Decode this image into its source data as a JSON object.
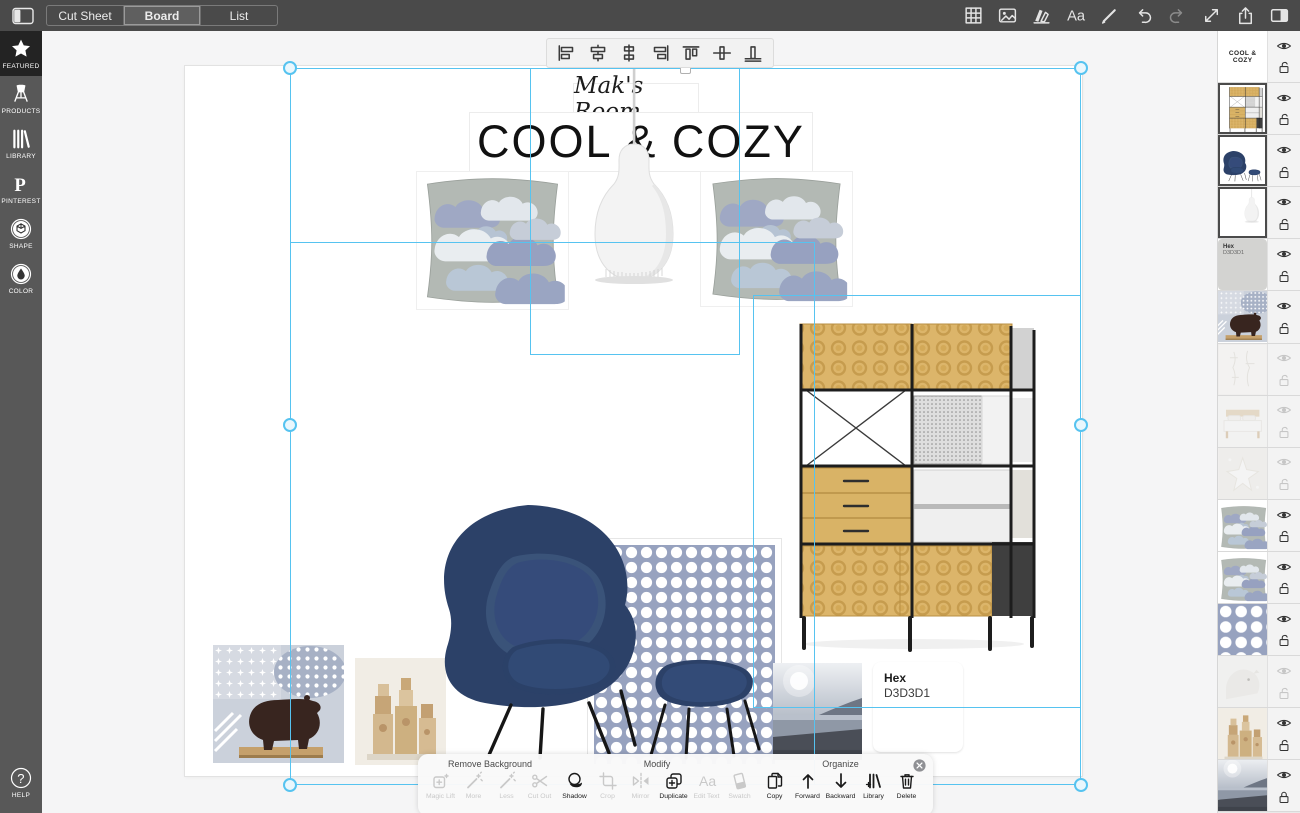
{
  "topbar": {
    "tabs": [
      {
        "label": "Cut Sheet",
        "selected": false
      },
      {
        "label": "Board",
        "selected": true
      },
      {
        "label": "List",
        "selected": false
      }
    ],
    "tools": [
      {
        "icon": "grid",
        "enabled": true
      },
      {
        "icon": "image",
        "enabled": true
      },
      {
        "icon": "boards",
        "enabled": true
      },
      {
        "icon": "text",
        "enabled": true
      },
      {
        "icon": "draw",
        "enabled": true
      },
      {
        "icon": "undo",
        "enabled": true
      },
      {
        "icon": "redo",
        "enabled": false
      },
      {
        "icon": "resize",
        "enabled": true
      },
      {
        "icon": "share",
        "enabled": true
      },
      {
        "icon": "panels",
        "enabled": true
      }
    ]
  },
  "sidebar": {
    "items": [
      {
        "label": "FEATURED",
        "icon": "star",
        "active": true
      },
      {
        "label": "PRODUCTS",
        "icon": "chair",
        "active": false
      },
      {
        "label": "LIBRARY",
        "icon": "books",
        "active": false
      },
      {
        "label": "PINTEREST",
        "icon": "pinterest",
        "active": false
      },
      {
        "label": "SHAPE",
        "icon": "cube",
        "active": false
      },
      {
        "label": "COLOR",
        "icon": "drop",
        "active": false
      }
    ],
    "help": {
      "label": "HELP",
      "icon": "question"
    }
  },
  "align_toolbar": {
    "icons": [
      "align-left",
      "align-center-h",
      "distribute-h",
      "align-right",
      "align-top",
      "align-middle-v",
      "align-bottom"
    ]
  },
  "board": {
    "subtitle": "Mak's Room",
    "title": "COOL & COZY"
  },
  "hex_swatch": {
    "label": "Hex",
    "value": "D3D3D1",
    "color": "#D3D3D1"
  },
  "layers": {
    "rows": [
      {
        "name": "title-text",
        "type": "text",
        "label": "COOL & COZY",
        "visible": true,
        "locked": false,
        "selected": false
      },
      {
        "name": "shelving-unit",
        "type": "image",
        "thumb": "shelving",
        "visible": true,
        "locked": false,
        "selected": true
      },
      {
        "name": "womb-chair",
        "type": "image",
        "thumb": "chair",
        "visible": true,
        "locked": false,
        "selected": true
      },
      {
        "name": "pendant-lamp",
        "type": "image",
        "thumb": "lamp",
        "visible": true,
        "locked": false,
        "selected": true
      },
      {
        "name": "hex-swatch",
        "type": "swatch",
        "label": "Hex",
        "value": "D3D3D1",
        "color": "#D3D3D1",
        "visible": true,
        "locked": false,
        "selected": false
      },
      {
        "name": "bear-figurine",
        "type": "image",
        "thumb": "bear",
        "visible": true,
        "locked": false,
        "selected": false
      },
      {
        "name": "sketch",
        "type": "image",
        "thumb": "sketch",
        "visible": false,
        "locked": false,
        "selected": false
      },
      {
        "name": "bed",
        "type": "image",
        "thumb": "bed",
        "visible": false,
        "locked": false,
        "selected": false
      },
      {
        "name": "starfish-fabric",
        "type": "image",
        "thumb": "star",
        "visible": false,
        "locked": false,
        "selected": false
      },
      {
        "name": "cloud-pillow",
        "type": "image",
        "thumb": "pillow",
        "visible": true,
        "locked": false,
        "selected": false
      },
      {
        "name": "cloud-pillow-2",
        "type": "image",
        "thumb": "pillow",
        "visible": true,
        "locked": false,
        "selected": false
      },
      {
        "name": "dot-fabric",
        "type": "image",
        "thumb": "dots",
        "visible": true,
        "locked": false,
        "selected": false
      },
      {
        "name": "polar-bear",
        "type": "image",
        "thumb": "polar",
        "visible": false,
        "locked": false,
        "selected": false
      },
      {
        "name": "wood-blocks",
        "type": "image",
        "thumb": "blocks",
        "visible": true,
        "locked": false,
        "selected": false
      },
      {
        "name": "seascape",
        "type": "image",
        "thumb": "sea",
        "visible": true,
        "locked": true,
        "selected": false
      }
    ]
  },
  "bottom_toolbar": {
    "sections": [
      {
        "title": "Remove Background",
        "items": [
          {
            "label": "Magic Lift",
            "icon": "magic-lift",
            "enabled": false
          },
          {
            "label": "More",
            "icon": "wand",
            "enabled": false
          },
          {
            "label": "Less",
            "icon": "wand",
            "enabled": false
          },
          {
            "label": "Cut Out",
            "icon": "scissors",
            "enabled": false
          }
        ]
      },
      {
        "title": "Modify",
        "items": [
          {
            "label": "Shadow",
            "icon": "shadow",
            "enabled": true
          },
          {
            "label": "Crop",
            "icon": "crop",
            "enabled": false
          },
          {
            "label": "Mirror",
            "icon": "mirror",
            "enabled": false
          },
          {
            "label": "Duplicate",
            "icon": "duplicate",
            "enabled": true
          },
          {
            "label": "Edit Text",
            "icon": "edit-text",
            "enabled": false
          },
          {
            "label": "Swatch",
            "icon": "swatch",
            "enabled": false
          }
        ]
      },
      {
        "title": "Organize",
        "items": [
          {
            "label": "Copy",
            "icon": "copy",
            "enabled": true
          },
          {
            "label": "Forward",
            "icon": "arrow-up",
            "enabled": true
          },
          {
            "label": "Backward",
            "icon": "arrow-down",
            "enabled": true
          },
          {
            "label": "Library",
            "icon": "library-add",
            "enabled": true
          },
          {
            "label": "Delete",
            "icon": "trash",
            "enabled": true
          }
        ]
      }
    ]
  },
  "colors": {
    "accent": "#56C3F0",
    "topbar": "#4A4A4A",
    "sidebar": "#585858",
    "canvas_bg": "#F5F5F6",
    "hex_swatch": "#D3D3D1"
  }
}
